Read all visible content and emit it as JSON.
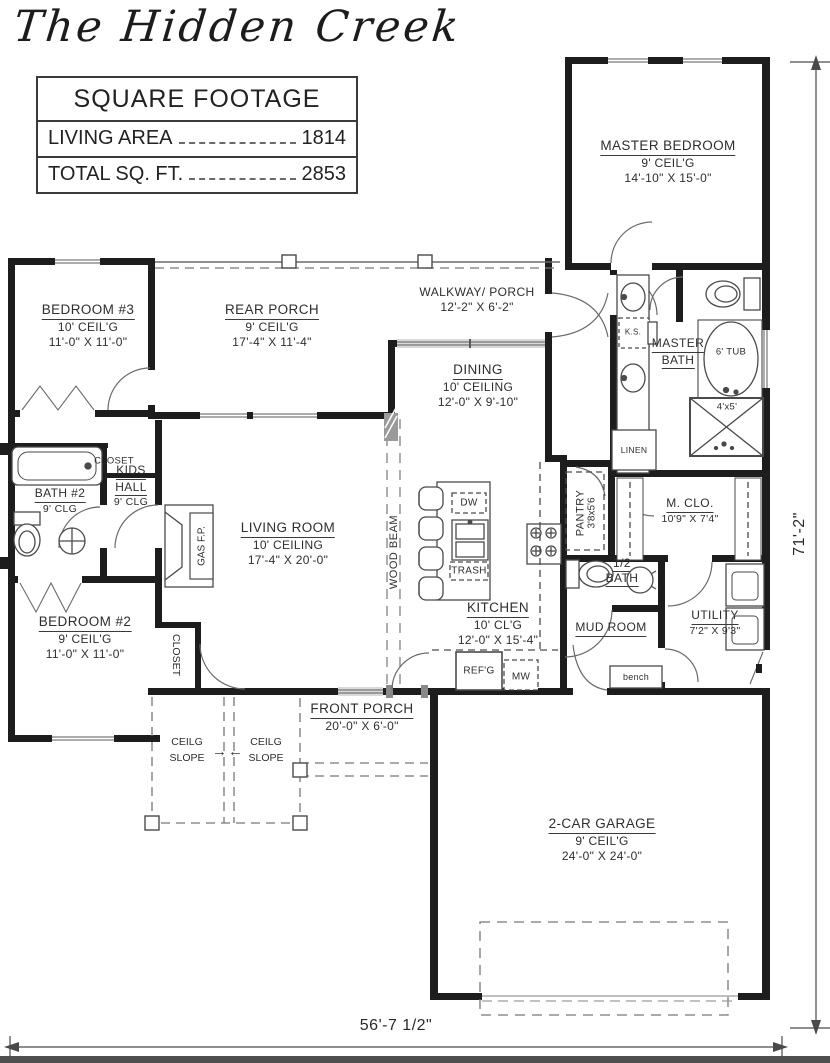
{
  "title": "The Hidden Creek",
  "square_footage": {
    "header": "SQUARE FOOTAGE",
    "rows": [
      {
        "label": "LIVING AREA",
        "value": "1814"
      },
      {
        "label": "TOTAL SQ. FT.",
        "value": "2853"
      }
    ]
  },
  "rooms": {
    "master_bedroom": {
      "name": "MASTER BEDROOM",
      "ceiling": "9' CEIL'G",
      "size": "14'-10\" X 15'-0\""
    },
    "bedroom_3": {
      "name": "BEDROOM #3",
      "ceiling": "10' CEIL'G",
      "size": "11'-0\" X 11'-0\""
    },
    "rear_porch": {
      "name": "REAR PORCH",
      "ceiling": "9' CEIL'G",
      "size": "17'-4\" X 11'-4\""
    },
    "walkway_porch": {
      "name": "WALKWAY/ PORCH",
      "size": "12'-2\" X 6'-2\""
    },
    "dining": {
      "name": "DINING",
      "ceiling": "10' CEILING",
      "size": "12'-0\" X 9'-10\""
    },
    "master_bath": {
      "name1": "MASTER",
      "name2": "BATH"
    },
    "kids_hall": {
      "name1": "KIDS",
      "name2": "HALL",
      "ceiling": "9' CLG"
    },
    "bath_2": {
      "name": "BATH #2",
      "ceiling": "9' CLG"
    },
    "living_room": {
      "name": "LIVING ROOM",
      "ceiling": "10' CEILING",
      "size": "17'-4\" X 20'-0\""
    },
    "kitchen": {
      "name": "KITCHEN",
      "ceiling": "10' CL'G",
      "size": "12'-0\" X 15'-4\""
    },
    "pantry": {
      "name": "PANTRY",
      "size": "3'8x5'6"
    },
    "master_closet": {
      "name": "M. CLO.",
      "size": "10'9\" X 7'4\""
    },
    "half_bath": {
      "name1": "1/2",
      "name2": "BATH"
    },
    "mud_room": {
      "name": "MUD ROOM"
    },
    "utility": {
      "name": "UTILITY",
      "size": "7'2\" X 9'3\""
    },
    "bedroom_2": {
      "name": "BEDROOM #2",
      "ceiling": "9' CEIL'G",
      "size": "11'-0\" X 11'-0\""
    },
    "front_porch": {
      "name": "FRONT PORCH",
      "size": "20'-0\" X 6'-0\""
    },
    "garage": {
      "name": "2-CAR GARAGE",
      "ceiling": "9' CEIL'G",
      "size": "24'-0\" X 24'-0\""
    }
  },
  "fixtures": {
    "closet_hall": "CLOSET",
    "closet_bedroom2": "CLOSET",
    "linen": "LINEN",
    "tub": "6' TUB",
    "shower": "4'x5'",
    "knee_space": "K.S.",
    "gas_fireplace": "GAS F.P.",
    "wood_beam": "WOOD BEAM",
    "dishwasher": "DW",
    "trash": "TRASH",
    "refrigerator": "REF'G",
    "microwave": "MW",
    "bench": "bench",
    "slope_line1": "CEILG",
    "slope_line2": "SLOPE"
  },
  "dimensions": {
    "overall_width": "56'-7 1/2\"",
    "overall_depth": "71'-2\""
  },
  "icons": {
    "arrow_right": "→",
    "arrow_left": "←"
  },
  "colors": {
    "wall": "#1d1d1d",
    "line": "#4a4a4a",
    "text": "#2e2e2e",
    "paper": "#ffffff"
  }
}
